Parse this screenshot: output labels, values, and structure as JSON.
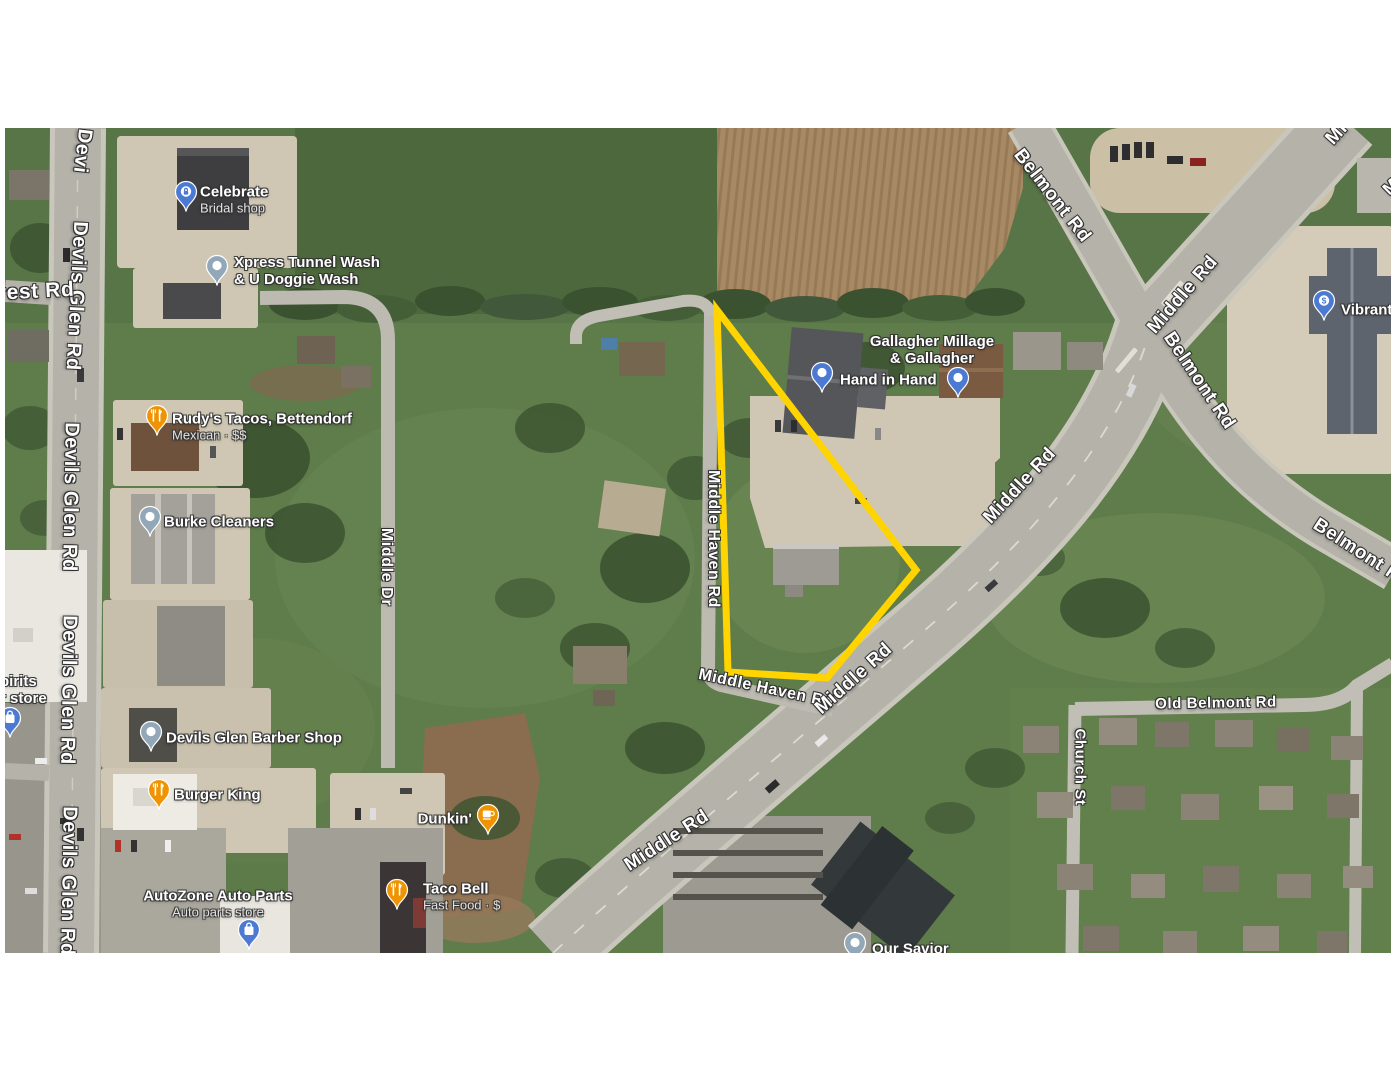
{
  "map": {
    "offset": {
      "x": 5,
      "y": 128
    },
    "parcel": {
      "color": "#ffd400",
      "stroke_width": 7,
      "points": [
        [
          717,
          310
        ],
        [
          916,
          570
        ],
        [
          827,
          678
        ],
        [
          728,
          672
        ]
      ]
    },
    "marker_colors": {
      "orange": "#ef9400",
      "blue": "#4c7ad3",
      "slate": "#92a8b9"
    },
    "road_labels": [
      {
        "text": "Devi",
        "x": 82,
        "y": 151,
        "rot": 97,
        "size": 20
      },
      {
        "text": "Devils Glen Rd",
        "x": 76,
        "y": 296,
        "rot": 93,
        "size": 20
      },
      {
        "text": "crest Rd",
        "x": 30,
        "y": 292,
        "rot": -3,
        "size": 21
      },
      {
        "text": "Devils Glen Rd",
        "x": 70,
        "y": 497,
        "rot": 91,
        "size": 20
      },
      {
        "text": "Devils Glen Rd",
        "x": 68,
        "y": 690,
        "rot": 91,
        "size": 20
      },
      {
        "text": "Devils Glen Rd",
        "x": 68,
        "y": 881,
        "rot": 91,
        "size": 20
      },
      {
        "text": "Middle Dr",
        "x": 386,
        "y": 567,
        "rot": 90,
        "size": 16
      },
      {
        "text": "Middle Haven Rd",
        "x": 713,
        "y": 539,
        "rot": 90,
        "size": 16
      },
      {
        "text": "Middle Haven Rd",
        "x": 766,
        "y": 689,
        "rot": 12,
        "size": 16
      },
      {
        "text": "Middle Rd",
        "x": 667,
        "y": 841,
        "rot": -33,
        "size": 19
      },
      {
        "text": "Middle Rd",
        "x": 854,
        "y": 679,
        "rot": -42,
        "size": 19
      },
      {
        "text": "Middle Rd",
        "x": 1020,
        "y": 486,
        "rot": -47,
        "size": 19
      },
      {
        "text": "Middle Rd",
        "x": 1183,
        "y": 295,
        "rot": -49,
        "size": 19
      },
      {
        "text": "Mi",
        "x": 1337,
        "y": 134,
        "rot": -48,
        "size": 19
      },
      {
        "text": "M",
        "x": 1391,
        "y": 187,
        "rot": -45,
        "size": 17
      },
      {
        "text": "Belmont Rd",
        "x": 1052,
        "y": 196,
        "rot": 52,
        "size": 19
      },
      {
        "text": "Belmont Rd",
        "x": 1199,
        "y": 381,
        "rot": 56,
        "size": 19
      },
      {
        "text": "Belmont Rd",
        "x": 1362,
        "y": 554,
        "rot": 33,
        "size": 19
      },
      {
        "text": "Old Belmont Rd",
        "x": 1216,
        "y": 703,
        "rot": -1,
        "size": 15
      },
      {
        "text": "Church St",
        "x": 1080,
        "y": 767,
        "rot": 90,
        "size": 15
      }
    ],
    "pois": [
      {
        "id": "celebrate-bridal-shop",
        "marker": {
          "x": 186,
          "y": 197,
          "type": "lock",
          "color": "blue"
        },
        "label": {
          "x": 200,
          "y": 200,
          "align": "left"
        },
        "lines": [
          {
            "text": "Celebrate"
          },
          {
            "text": "Bridal shop",
            "sub": true
          }
        ]
      },
      {
        "id": "xpress-tunnel-wash",
        "marker": {
          "x": 217,
          "y": 271,
          "type": "generic",
          "color": "slate"
        },
        "label": {
          "x": 234,
          "y": 271,
          "align": "left"
        },
        "lines": [
          {
            "text": "Xpress Tunnel Wash"
          },
          {
            "text": "& U Doggie Wash"
          }
        ]
      },
      {
        "id": "rudys-tacos",
        "marker": {
          "x": 157,
          "y": 421,
          "type": "restaurant",
          "color": "orange"
        },
        "label": {
          "x": 172,
          "y": 427,
          "align": "left"
        },
        "lines": [
          {
            "text": "Rudy's Tacos, Bettendorf"
          },
          {
            "text": "Mexican · $$",
            "sub": true
          }
        ]
      },
      {
        "id": "burke-cleaners",
        "marker": {
          "x": 150,
          "y": 522,
          "type": "generic",
          "color": "slate"
        },
        "label": {
          "x": 164,
          "y": 522,
          "align": "left"
        },
        "lines": [
          {
            "text": "Burke Cleaners"
          }
        ]
      },
      {
        "id": "devils-glen-barber-shop",
        "marker": {
          "x": 151,
          "y": 737,
          "type": "generic",
          "color": "slate"
        },
        "label": {
          "x": 166,
          "y": 738,
          "align": "left"
        },
        "lines": [
          {
            "text": "Devils Glen Barber Shop"
          }
        ]
      },
      {
        "id": "burger-king",
        "marker": {
          "x": 159,
          "y": 795,
          "type": "restaurant",
          "color": "orange"
        },
        "label": {
          "x": 174,
          "y": 795,
          "align": "left"
        },
        "lines": [
          {
            "text": "Burger King"
          }
        ]
      },
      {
        "id": "autozone",
        "marker": {
          "x": 249,
          "y": 935,
          "type": "bag",
          "color": "blue"
        },
        "label": {
          "x": 218,
          "y": 904,
          "align": "center"
        },
        "lines": [
          {
            "text": "AutoZone Auto Parts"
          },
          {
            "text": "Auto parts store",
            "sub": true
          }
        ]
      },
      {
        "id": "dunkin",
        "marker": {
          "x": 488,
          "y": 820,
          "type": "coffee",
          "color": "orange"
        },
        "label": {
          "x": 472,
          "y": 819,
          "align": "right"
        },
        "lines": [
          {
            "text": "Dunkin'"
          }
        ]
      },
      {
        "id": "taco-bell",
        "marker": {
          "x": 397,
          "y": 895,
          "type": "restaurant",
          "color": "orange"
        },
        "label": {
          "x": 423,
          "y": 897,
          "align": "left"
        },
        "lines": [
          {
            "text": "Taco Bell"
          },
          {
            "text": "Fast Food · $",
            "sub": true
          }
        ]
      },
      {
        "id": "hand-in-hand",
        "marker": {
          "x": 822,
          "y": 378,
          "type": "generic",
          "color": "blue"
        },
        "label": {
          "x": 840,
          "y": 380,
          "align": "left"
        },
        "lines": [
          {
            "text": "Hand in Hand"
          }
        ]
      },
      {
        "id": "gallagher-millage",
        "marker": {
          "x": 958,
          "y": 383,
          "type": "generic",
          "color": "blue"
        },
        "label": {
          "x": 932,
          "y": 350,
          "align": "center"
        },
        "lines": [
          {
            "text": "Gallagher Millage"
          },
          {
            "text": "& Gallagher"
          }
        ]
      },
      {
        "id": "vibrant-credit-union",
        "marker": {
          "x": 1324,
          "y": 306,
          "type": "dollar",
          "color": "blue"
        },
        "label": {
          "x": 1341,
          "y": 310,
          "align": "left"
        },
        "lines": [
          {
            "text": "Vibrant Cr"
          }
        ]
      },
      {
        "id": "liquor-store-partial",
        "marker": {
          "x": 10,
          "y": 723,
          "type": "bag",
          "color": "blue"
        },
        "label": {
          "x": 0,
          "y": 690,
          "align": "left"
        },
        "lines": [
          {
            "text": "pirits"
          },
          {
            "text": "r store"
          }
        ]
      },
      {
        "id": "our-savior",
        "marker": {
          "x": 855,
          "y": 948,
          "type": "generic",
          "color": "slate"
        },
        "label": {
          "x": 872,
          "y": 949,
          "align": "left"
        },
        "lines": [
          {
            "text": "Our Savior"
          }
        ]
      }
    ]
  }
}
